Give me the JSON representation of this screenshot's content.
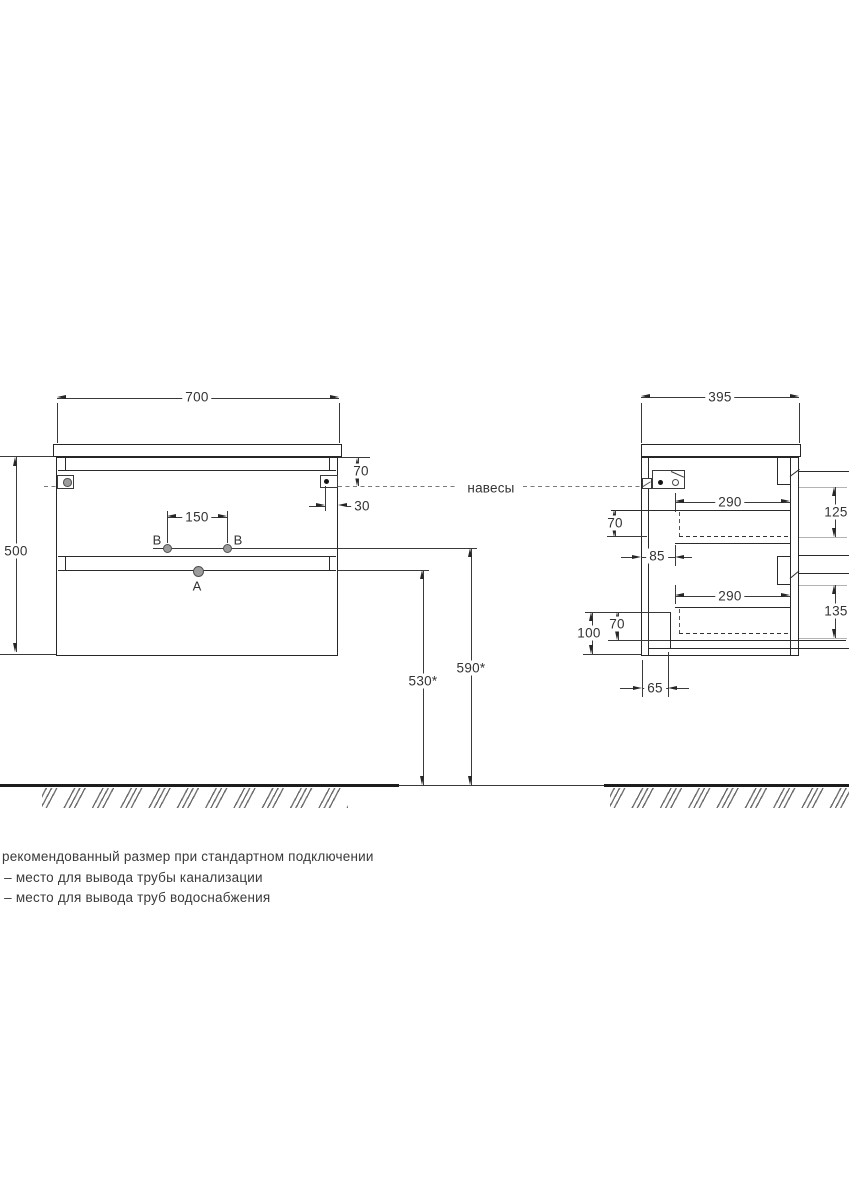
{
  "front_view": {
    "width": "700",
    "height": "500",
    "rail_height": "70",
    "hinge_inset": "30",
    "holes_gap": "150",
    "hole_a": "А",
    "hole_b_left": "В",
    "hole_b_right": "В",
    "drain_height": "530*",
    "supply_height": "590*"
  },
  "side_view": {
    "depth": "395",
    "drawer_len_top": "290",
    "drawer_len_bottom": "290",
    "drawer_inner_top": "70",
    "drawer_inner_bottom": "70",
    "back_gap": "85",
    "front_height_top": "125",
    "front_height_bottom": "135",
    "bottom_gap": "100",
    "plinth_offset": "65"
  },
  "labels": {
    "hangers": "навесы"
  },
  "notes": [
    "рекомендованный размер при стандартном подключении",
    "А – место для вывода трубы канализации",
    "В – место для вывода труб водоснабжения"
  ],
  "colors": {
    "line": "#2a2a2a",
    "ref": "#b3b3b3",
    "ground": "#1c1c1c",
    "text": "#383838"
  }
}
